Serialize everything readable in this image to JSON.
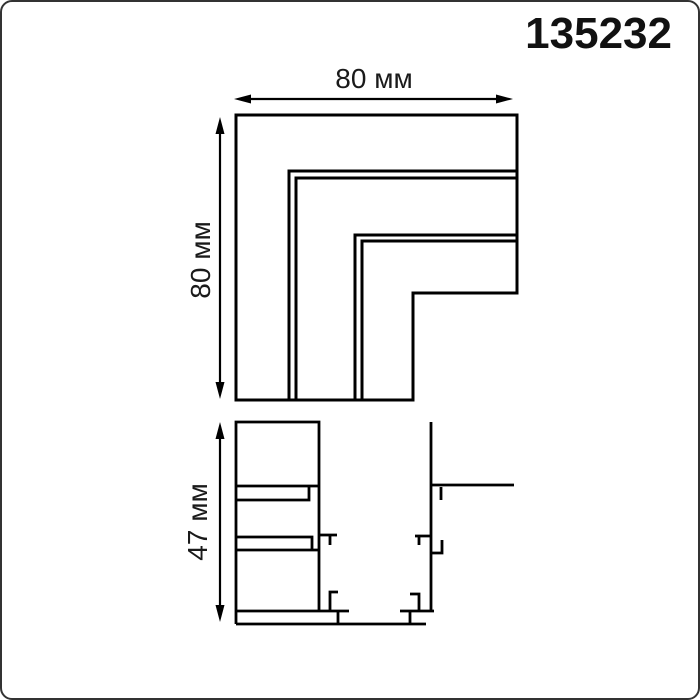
{
  "page": {
    "article_number": "135232",
    "background_color": "#ffffff",
    "line_color": "#000000",
    "border_color": "#333333"
  },
  "top_view": {
    "width_label": "80 мм",
    "height_label": "80 мм"
  },
  "side_view": {
    "height_label": "47 мм"
  }
}
